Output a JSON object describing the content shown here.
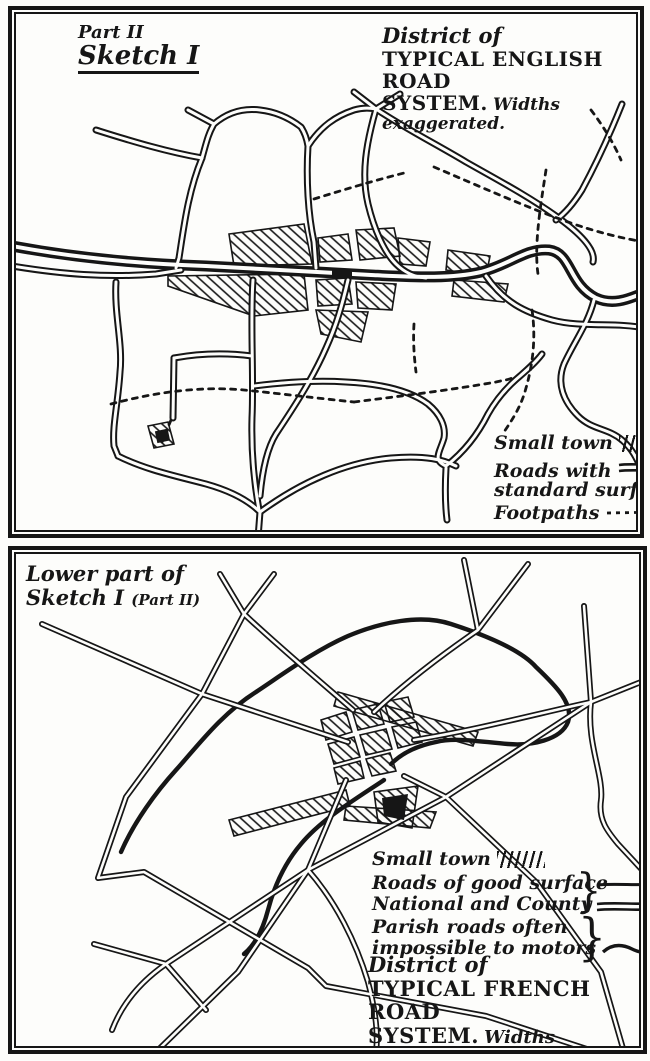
{
  "ink_color": "#161616",
  "paper_color": "#fdfdfb",
  "top_panel": {
    "part_label": "Part II",
    "sketch_label": "Sketch I",
    "title": {
      "prefix": "District of",
      "line1": "TYPICAL ENGLISH ROAD",
      "line2": "SYSTEM.",
      "note": "Widths exaggerated."
    },
    "legend": {
      "items": [
        {
          "label": "Small town",
          "symbol": "town-hatch"
        },
        {
          "label": "Roads with",
          "label2": "standard surface",
          "symbol": "double-line"
        },
        {
          "label": "Footpaths",
          "symbol": "dotted-line"
        }
      ]
    }
  },
  "bottom_panel": {
    "caption_line1": "Lower part of",
    "caption_line2": "Sketch I",
    "caption_paren": "(Part II)",
    "legend": {
      "items": [
        {
          "label": "Small town",
          "symbol": "town-hatch"
        },
        {
          "label": "Roads of good surface",
          "label2": "National and County",
          "brace": "}",
          "symbol": "single-and-double-line"
        },
        {
          "label": "Parish roads often",
          "label2": "impossible to motors",
          "brace": "}",
          "symbol": "wavy-line"
        }
      ]
    },
    "title": {
      "prefix": "District of",
      "line1": "TYPICAL FRENCH ROAD",
      "line2": "SYSTEM.",
      "note": "Widths exaggerated.",
      "note2": "Same scale as above"
    }
  }
}
